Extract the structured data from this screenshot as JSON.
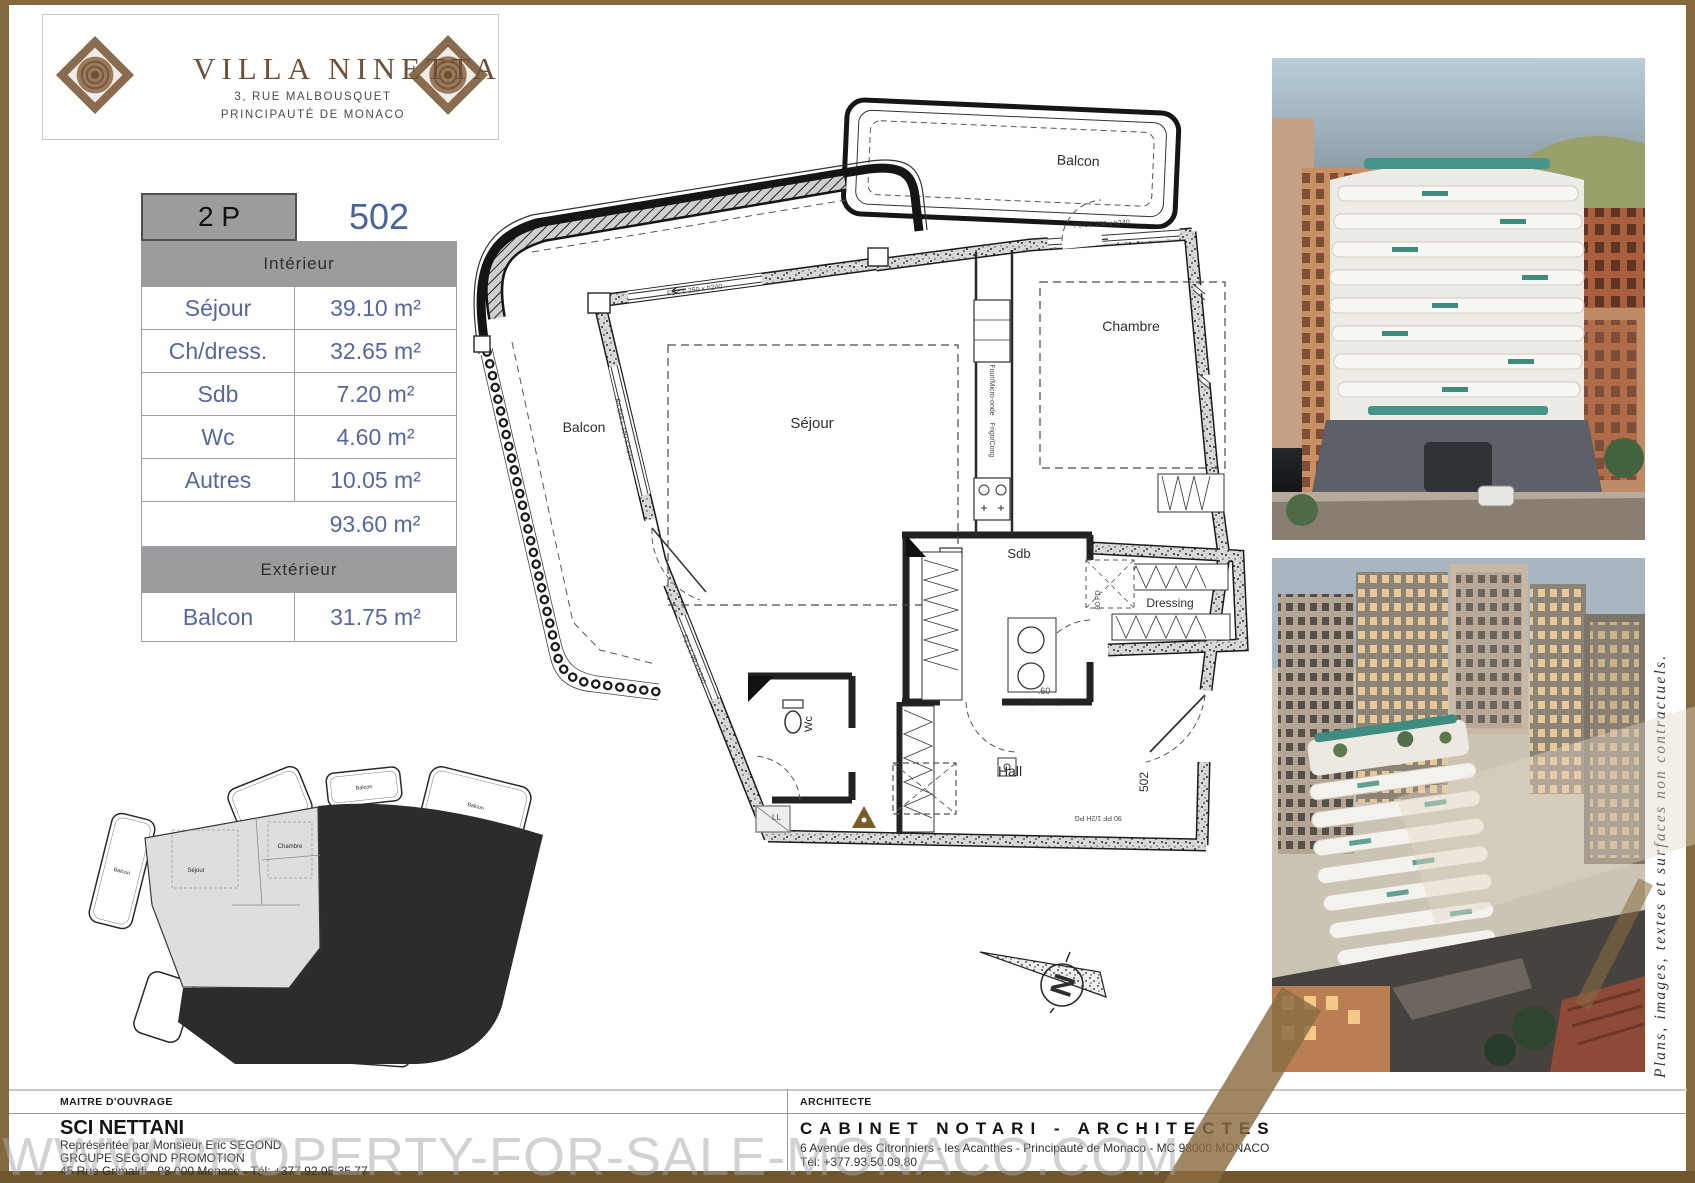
{
  "logo": {
    "title": "VILLA NINETTA",
    "address_line1": "3, RUE MALBOUSQUET",
    "address_line2": "PRINCIPAUTÉ DE MONACO"
  },
  "unit_table": {
    "type_label": "2 P",
    "unit_number": "502",
    "interior_header": "Intérieur",
    "rows": [
      {
        "label": "Séjour",
        "value": "39.10 m²"
      },
      {
        "label": "Ch/dress.",
        "value": "32.65 m²"
      },
      {
        "label": "Sdb",
        "value": "7.20 m²"
      },
      {
        "label": "Wc",
        "value": "4.60 m²"
      },
      {
        "label": "Autres",
        "value": "10.05 m²"
      }
    ],
    "total_value": "93.60 m²",
    "exterior_header": "Extérieur",
    "exterior_row": {
      "label": "Balcon",
      "value": "31.75 m²"
    }
  },
  "floor_plan": {
    "room_labels": {
      "balcon_left": "Balcon",
      "balcon_top": "Balcon",
      "sejour": "Séjour",
      "chambre": "Chambre",
      "sdb": "Sdb",
      "dressing": "Dressing",
      "hall": "Hall",
      "wc": "Wc"
    },
    "annotations": {
      "unit_number": "502",
      "dim_60": ".60",
      "door_entry": "90 PF 1/2H PG",
      "door_sdb": "80 PD",
      "window_top": "F5.c L 250 x h240",
      "window_top2": "F5.c L 250 x h240",
      "window_left": "F4.6x8 L 150 x h240",
      "window_left2": "F3.1 L 90 x h240",
      "kitchen1": "Four/Micro-onde",
      "kitchen2": "Frigo/Cong",
      "washer": "LL"
    }
  },
  "key_plan": {
    "balcon_label": "Balcon",
    "sejour_label": "Séjour",
    "chambre_label": "Chambre"
  },
  "compass": {
    "north_letter": "N"
  },
  "side_note": "Plans, images, textes et surfaces non contractuels.",
  "watermark": "WWW.PROPERTY-FOR-SALE-MONACO.COM",
  "footer": {
    "owner_label": "MAITRE D'OUVRAGE",
    "owner_name": "SCI NETTANI",
    "owner_line1": "Représentée par Monsieur Eric SEGOND",
    "owner_line2": "GROUPE SEGOND PROMOTION",
    "owner_line3": "45 Rue Grimaldi - 98 000 Monaco -  Tél: +377.92.05.35.77",
    "architect_label": "ARCHITECTE",
    "architect_name": "CABINET NOTARI - ARCHITECTES",
    "architect_line1": "6 Avenue des Citronniers - les Acanthes - Principauté de Monaco - MC 98000 MONACO",
    "architect_line2": "Tél: +377.93.50.09.80"
  },
  "colors": {
    "frame_gold": "#85693E",
    "frame_gold_dark": "#6E572E",
    "table_blue": "#4A639C",
    "band_gray": "#9C9C9C",
    "logo_brown": "#6F5139"
  }
}
